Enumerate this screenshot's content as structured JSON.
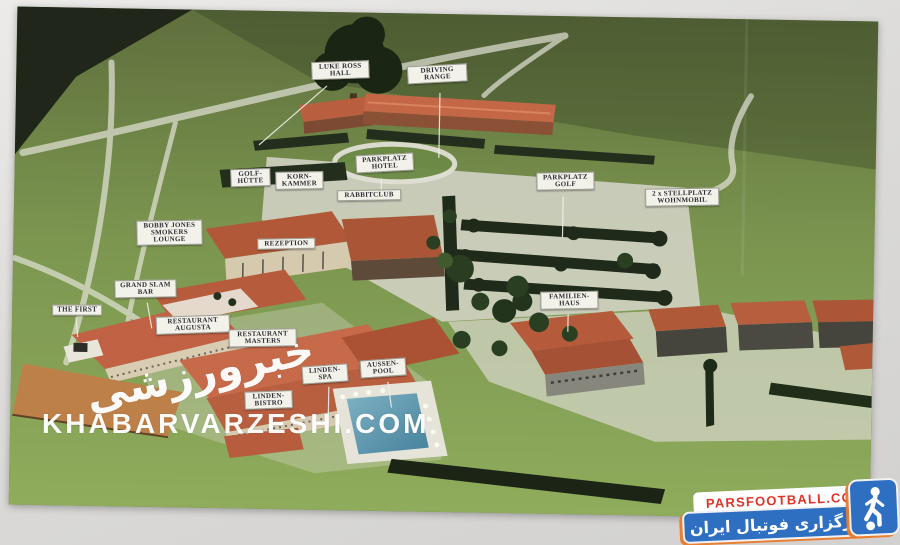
{
  "photo": {
    "description": "Aerial view of an architectural scale model of a golf resort with white label signs",
    "labels": [
      {
        "id": "luke-ross-hall",
        "lines": [
          "LUKE ROSS",
          "HALL"
        ],
        "x": 308,
        "y": 63,
        "w": 58,
        "tilt": -3
      },
      {
        "id": "driving-range",
        "lines": [
          "DRIVING",
          "RANGE"
        ],
        "x": 404,
        "y": 65,
        "w": 60,
        "tilt": -4
      },
      {
        "id": "parkplatz-hotel",
        "lines": [
          "PARKPLATZ",
          "HOTEL"
        ],
        "x": 354,
        "y": 155,
        "w": 58,
        "tilt": -4
      },
      {
        "id": "golf-huette",
        "lines": [
          "GOLF-",
          "HÜTTE"
        ],
        "x": 229,
        "y": 172,
        "w": 40,
        "tilt": -3
      },
      {
        "id": "korn-kammer",
        "lines": [
          "KORN-",
          "KAMMER"
        ],
        "x": 274,
        "y": 174,
        "w": 48,
        "tilt": -2
      },
      {
        "id": "rabbitclub",
        "lines": [
          "RABBITCLUB"
        ],
        "x": 336,
        "y": 191,
        "w": 64,
        "tilt": -2
      },
      {
        "id": "parkplatz-golf",
        "lines": [
          "PARKPLATZ",
          "GOLF"
        ],
        "x": 535,
        "y": 170,
        "w": 58,
        "tilt": -2
      },
      {
        "id": "stellplatz-wohnmobil",
        "lines": [
          "2 x STELLPLATZ",
          "WOHNMOBIL"
        ],
        "x": 644,
        "y": 184,
        "w": 74,
        "tilt": -2
      },
      {
        "id": "bobby-jones-smokers-lounge",
        "lines": [
          "BOBBY JONES",
          "SMOKERS",
          "LOUNGE"
        ],
        "x": 136,
        "y": 225,
        "w": 66,
        "tilt": -2
      },
      {
        "id": "rezeption",
        "lines": [
          "REZEPTION"
        ],
        "x": 257,
        "y": 241,
        "w": 58,
        "tilt": -2
      },
      {
        "id": "grand-slam-bar",
        "lines": [
          "GRAND SLAM",
          "BAR"
        ],
        "x": 115,
        "y": 285,
        "w": 62,
        "tilt": -2
      },
      {
        "id": "the-first",
        "lines": [
          "THE FIRST"
        ],
        "x": 53,
        "y": 311,
        "w": 50,
        "tilt": -1
      },
      {
        "id": "restaurant-augusta",
        "lines": [
          "RESTAURANT",
          "AUGUSTA"
        ],
        "x": 157,
        "y": 320,
        "w": 74,
        "tilt": -3
      },
      {
        "id": "restaurant-masters",
        "lines": [
          "RESTAURANT",
          "MASTERS"
        ],
        "x": 230,
        "y": 332,
        "w": 68,
        "tilt": -2
      },
      {
        "id": "familien-haus",
        "lines": [
          "FAMILIEN-",
          "HAUS"
        ],
        "x": 541,
        "y": 289,
        "w": 58,
        "tilt": -2
      },
      {
        "id": "aussen-pool",
        "lines": [
          "AUSSEN-",
          "POOL"
        ],
        "x": 362,
        "y": 360,
        "w": 46,
        "tilt": -5
      },
      {
        "id": "linden-spa",
        "lines": [
          "LINDEN-",
          "SPA"
        ],
        "x": 304,
        "y": 367,
        "w": 46,
        "tilt": -5
      },
      {
        "id": "linden-bistro",
        "lines": [
          "LINDEN-",
          "BISTRO"
        ],
        "x": 247,
        "y": 394,
        "w": 48,
        "tilt": -3
      }
    ]
  },
  "watermark": {
    "logo_fa": "خبرورزشی",
    "site": "KHABARVARZESHI.COM"
  },
  "branding": {
    "site": "PARSFOOTBALL.COM",
    "tagline_fa": "خبرگزاری فوتبال ایران",
    "colors": {
      "red": "#e0342a",
      "blue": "#2e6fc2",
      "orange": "#e87b2c",
      "white": "#ffffff"
    }
  }
}
